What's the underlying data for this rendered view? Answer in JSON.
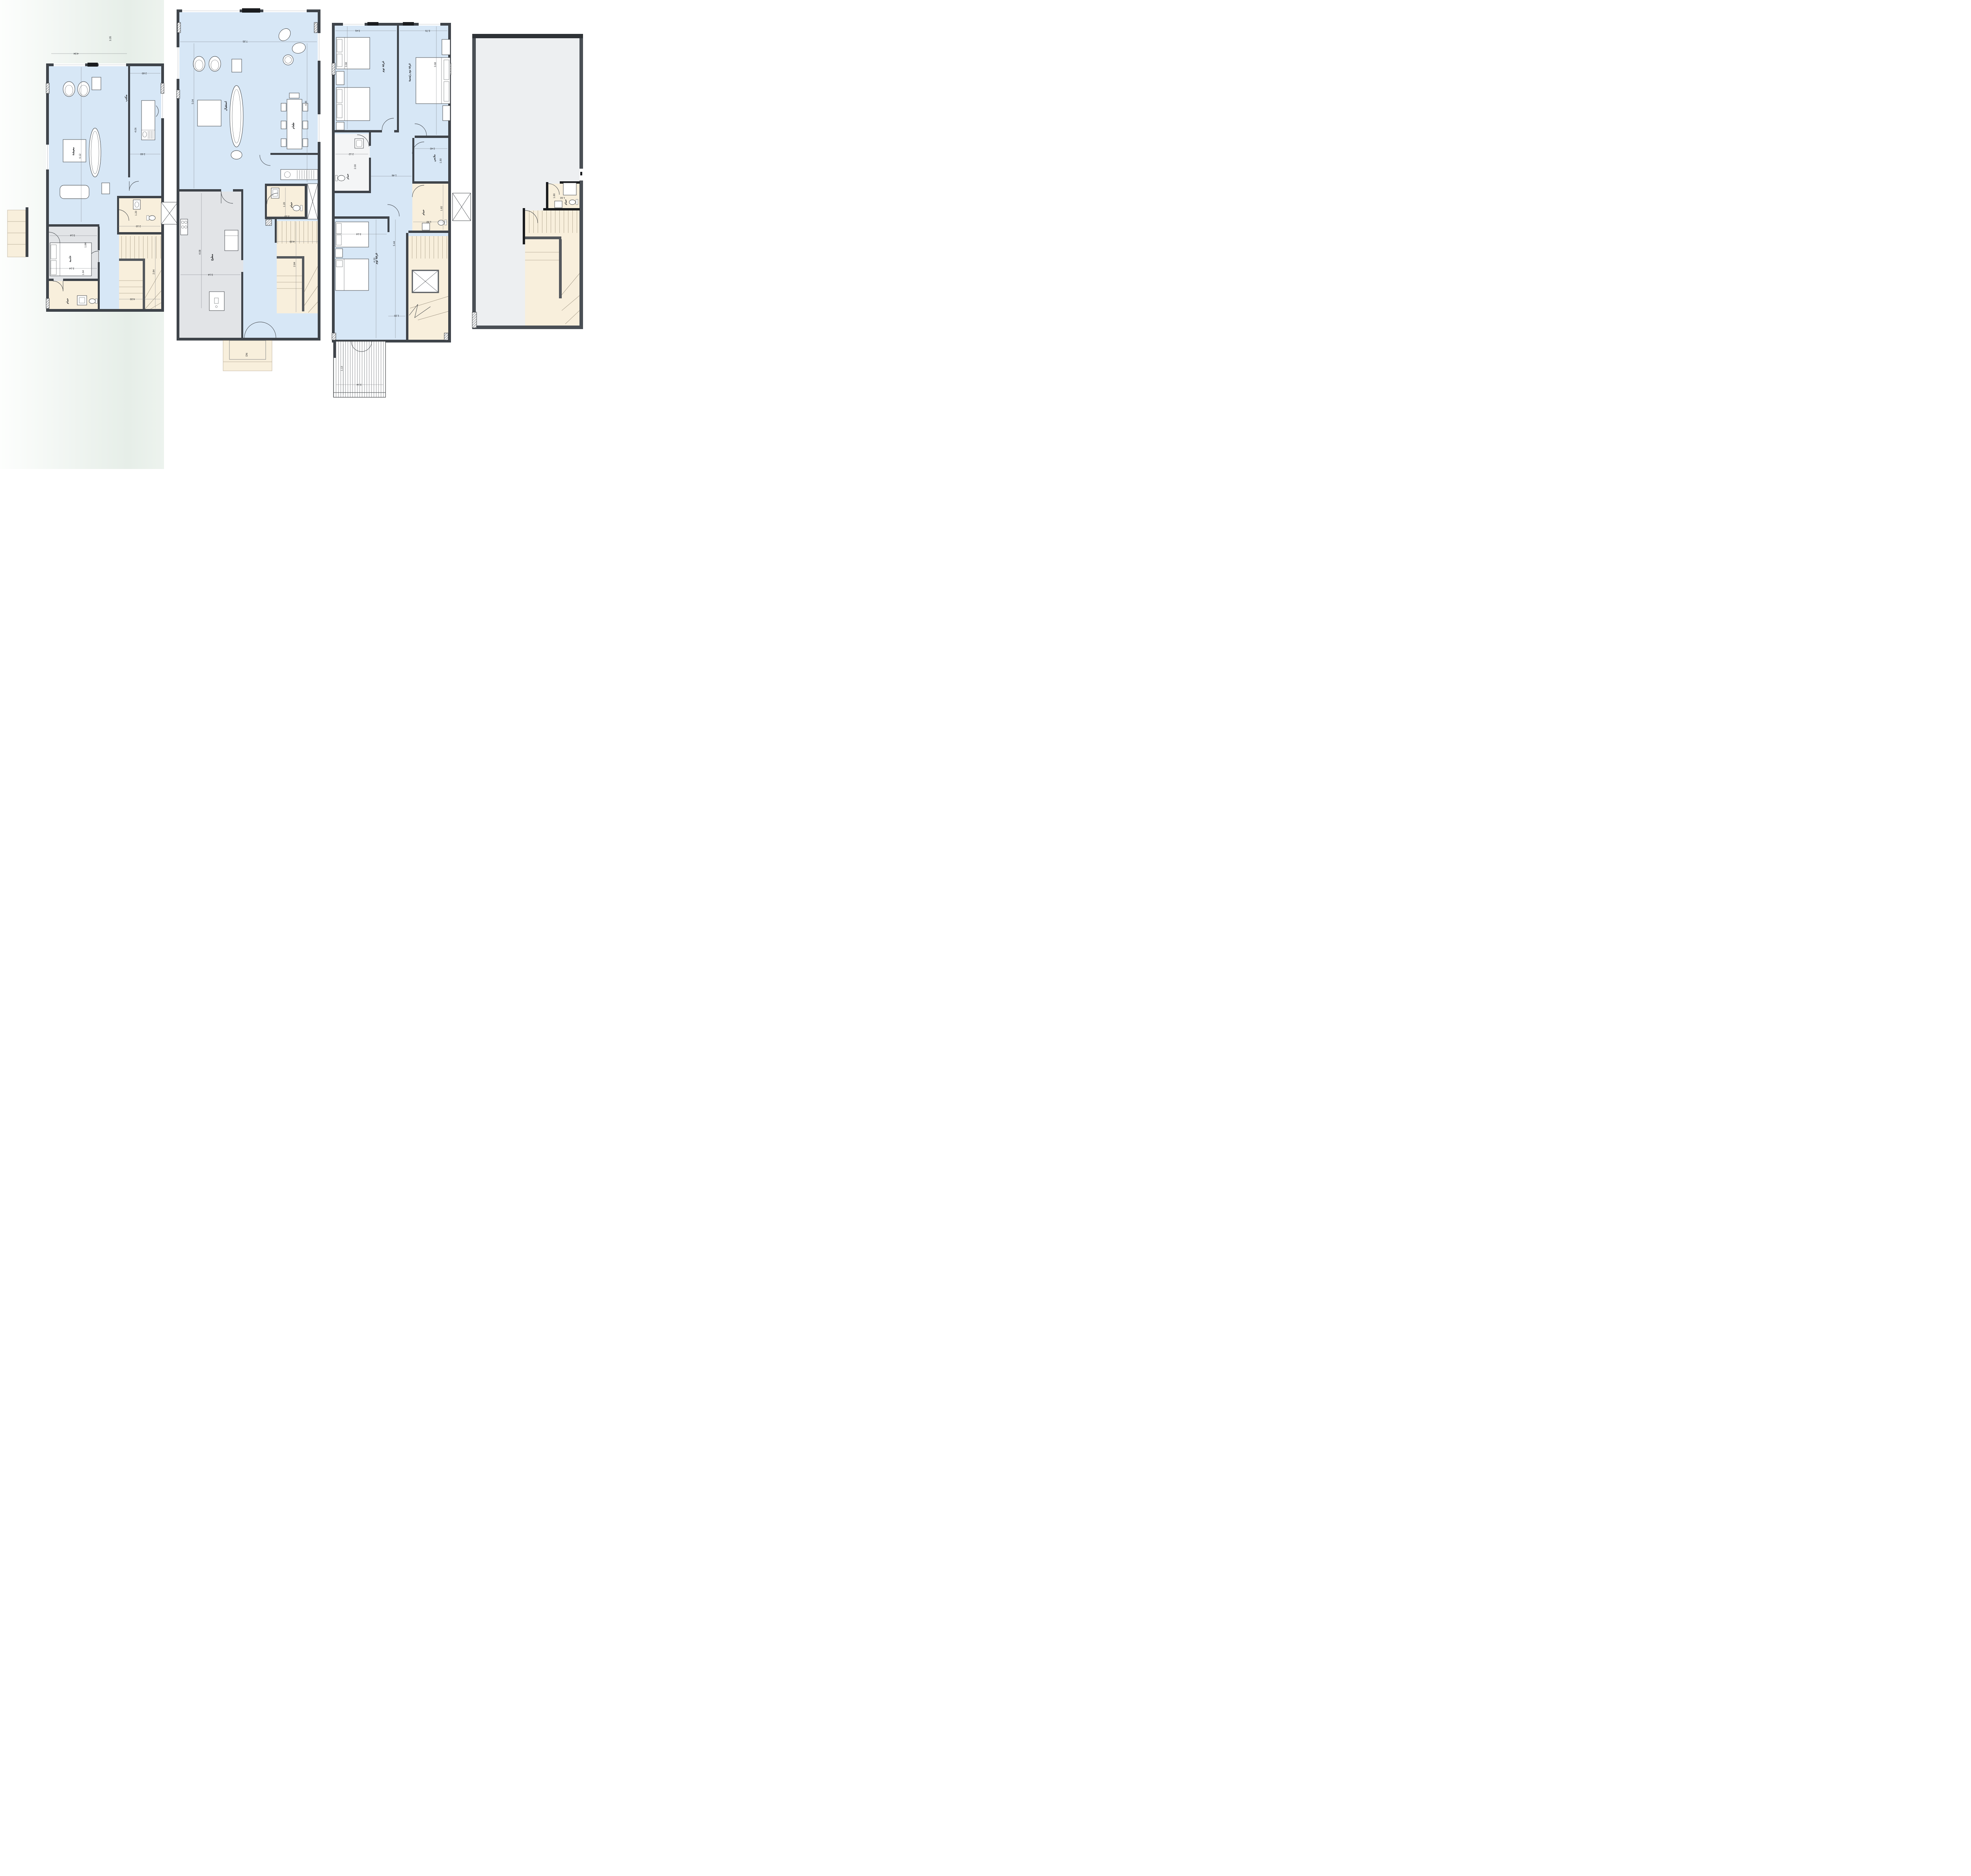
{
  "document": {
    "type": "architectural-floor-plan-sheet",
    "plans_count": 4,
    "language": "Arabic"
  },
  "colors": {
    "wall": "#3f444a",
    "wall_accent": "#1a1c1f",
    "room_fill": "#d7e7f6",
    "service_fill": "#e2e4e7",
    "stair_fill": "#f8efdc",
    "roof_fill": "#eceef0",
    "band_green": "#e6eee8"
  },
  "site": {
    "stray_dim": "3.35"
  },
  "plan_a": {
    "labels": {
      "living": "معيشة",
      "office": "مكتب",
      "maid_room": "خادمة",
      "bathroom": "حمام"
    },
    "dims": {
      "top_width": "4.54",
      "office_top": "2.60",
      "living_height": "6.12",
      "office_height": "4.06",
      "office_bottom": "2.60",
      "maid_width": "3.14",
      "maid_depth": "1.84",
      "bath_width": "3.14",
      "bath_depth": "1.64",
      "wc_width": "1.20",
      "wc_length": "2.10",
      "stair_depth": "2.84",
      "stair_width": "4.00"
    }
  },
  "plan_b": {
    "labels": {
      "reception": "استقبال",
      "dining": "طعام",
      "kitchen": "مطبخ",
      "bathroom": "حمام",
      "entry_marker": "DN"
    },
    "dims": {
      "top_width": "7.35",
      "left_height": "5.04",
      "right_height": "4.96",
      "kitchen_height": "4.08",
      "kitchen_width": "3.14",
      "bath_width": "1.20",
      "bath_length": "2.10",
      "stair_width": "4.00",
      "stair_depth": "2.84"
    }
  },
  "plan_c": {
    "labels": {
      "bedroom1": "غرفة نوم",
      "master_bedroom": "غرفة نوم رئيسية",
      "bathroom1": "حمام",
      "closet": "ملابس",
      "bathroom2": "حمام",
      "bedroom2": "غرفة نوم"
    },
    "dims": {
      "bedroom1_width": "3.41",
      "master_width": "3.70",
      "bedroom1_height": "3.68",
      "master_height": "3.68",
      "bath1_width": "2.12",
      "bath1_height": "2.00",
      "closet_width": "2.42",
      "closet_height": "1.80",
      "hall_width": "1.46",
      "hall_height": "5.44",
      "bedroom2_width": "3.14",
      "bedroom2_height": "4.20",
      "bath2_width": "1.92",
      "bath2_height": "1.82",
      "stair_hall_width": "1.20",
      "balcony_depth": "1.13",
      "balcony_width": "3.14"
    }
  },
  "plan_d": {
    "labels": {
      "bathroom": "حمام"
    },
    "dims": {
      "bath_height": "1.80",
      "bath_width": "1.92"
    }
  }
}
